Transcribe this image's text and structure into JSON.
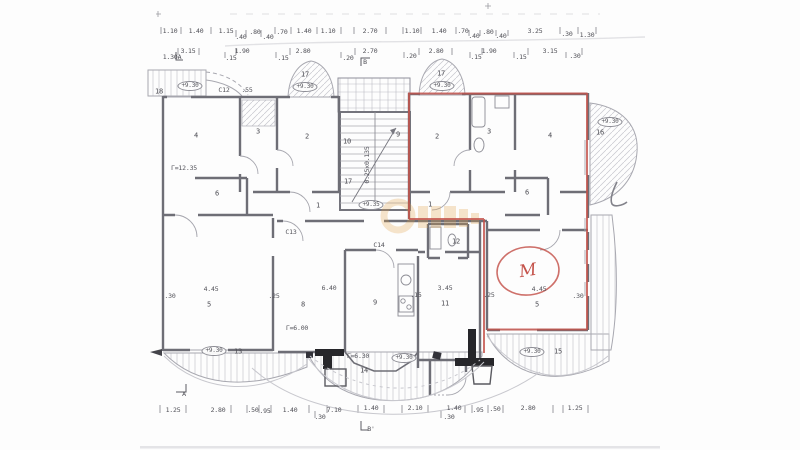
{
  "plan": {
    "red_marker_letter": "M",
    "red_color": "#c4524a",
    "watermark_color": "#e2a24b",
    "stair_note": "0.25x0.135"
  },
  "labels": {
    "dims_top_row1": [
      {
        "t": "1.10",
        "x": 170,
        "y": 31
      },
      {
        "t": "1.40",
        "x": 196,
        "y": 31
      },
      {
        "t": "1.15",
        "x": 226,
        "y": 31
      },
      {
        "t": ".40",
        "x": 241,
        "y": 37
      },
      {
        "t": ".80",
        "x": 255,
        "y": 32
      },
      {
        "t": ".40",
        "x": 268,
        "y": 37
      },
      {
        "t": ".70",
        "x": 282,
        "y": 32
      },
      {
        "t": "1.40",
        "x": 304,
        "y": 31
      },
      {
        "t": "1.10",
        "x": 328,
        "y": 31
      },
      {
        "t": "2.70",
        "x": 370,
        "y": 31
      },
      {
        "t": "1.10",
        "x": 412,
        "y": 31
      },
      {
        "t": "1.40",
        "x": 439,
        "y": 31
      },
      {
        "t": ".70",
        "x": 463,
        "y": 31
      },
      {
        "t": ".40",
        "x": 474,
        "y": 36
      },
      {
        "t": ".80",
        "x": 488,
        "y": 32
      },
      {
        "t": ".40",
        "x": 501,
        "y": 36
      },
      {
        "t": "3.25",
        "x": 535,
        "y": 31
      },
      {
        "t": ".30",
        "x": 567,
        "y": 34
      },
      {
        "t": "1.30",
        "x": 587,
        "y": 35
      }
    ],
    "dims_top_row2": [
      {
        "t": "1.30A",
        "x": 172,
        "y": 57
      },
      {
        "t": "3.15",
        "x": 188,
        "y": 51
      },
      {
        "t": ".15",
        "x": 231,
        "y": 58
      },
      {
        "t": "1.90",
        "x": 242,
        "y": 51
      },
      {
        "t": ".15",
        "x": 283,
        "y": 58
      },
      {
        "t": "2.80",
        "x": 303,
        "y": 51
      },
      {
        "t": ".20",
        "x": 348,
        "y": 58
      },
      {
        "t": "2.70",
        "x": 370,
        "y": 51
      },
      {
        "t": "B",
        "x": 365,
        "y": 62
      },
      {
        "t": ".20",
        "x": 411,
        "y": 56
      },
      {
        "t": "2.80",
        "x": 436,
        "y": 51
      },
      {
        "t": ".15",
        "x": 476,
        "y": 57
      },
      {
        "t": "1.90",
        "x": 489,
        "y": 51
      },
      {
        "t": ".15",
        "x": 521,
        "y": 57
      },
      {
        "t": "3.15",
        "x": 550,
        "y": 51
      },
      {
        "t": ".30",
        "x": 575,
        "y": 56
      }
    ],
    "dims_bottom": [
      {
        "t": "1.25",
        "x": 173,
        "y": 410
      },
      {
        "t": "2.80",
        "x": 218,
        "y": 410
      },
      {
        "t": ".50",
        "x": 253,
        "y": 410
      },
      {
        "t": ".95",
        "x": 265,
        "y": 411
      },
      {
        "t": "1.40",
        "x": 290,
        "y": 410
      },
      {
        "t": ".30",
        "x": 320,
        "y": 417
      },
      {
        "t": "7.10",
        "x": 334,
        "y": 410
      },
      {
        "t": "1.40",
        "x": 371,
        "y": 408
      },
      {
        "t": "2.10",
        "x": 415,
        "y": 408
      },
      {
        "t": "1.40",
        "x": 454,
        "y": 408
      },
      {
        "t": ".30",
        "x": 449,
        "y": 417
      },
      {
        "t": ".95",
        "x": 478,
        "y": 410
      },
      {
        "t": ".50",
        "x": 495,
        "y": 409
      },
      {
        "t": "2.80",
        "x": 528,
        "y": 408
      },
      {
        "t": "1.25",
        "x": 575,
        "y": 408
      },
      {
        "t": "A",
        "x": 184,
        "y": 394
      },
      {
        "t": "B'",
        "x": 371,
        "y": 429
      }
    ],
    "rooms": [
      {
        "t": "4",
        "x": 196,
        "y": 136
      },
      {
        "t": "3",
        "x": 258,
        "y": 132
      },
      {
        "t": "2",
        "x": 307,
        "y": 137
      },
      {
        "t": "2",
        "x": 437,
        "y": 137
      },
      {
        "t": "3",
        "x": 489,
        "y": 132
      },
      {
        "t": "4",
        "x": 550,
        "y": 136
      },
      {
        "t": "1",
        "x": 318,
        "y": 206
      },
      {
        "t": "1",
        "x": 430,
        "y": 205
      },
      {
        "t": "6",
        "x": 217,
        "y": 194
      },
      {
        "t": "6",
        "x": 527,
        "y": 193
      },
      {
        "t": "5",
        "x": 209,
        "y": 305
      },
      {
        "t": "8",
        "x": 303,
        "y": 305
      },
      {
        "t": "9",
        "x": 375,
        "y": 303
      },
      {
        "t": "11",
        "x": 445,
        "y": 304
      },
      {
        "t": "12",
        "x": 456,
        "y": 242
      },
      {
        "t": "5",
        "x": 537,
        "y": 305
      },
      {
        "t": "13",
        "x": 238,
        "y": 352
      },
      {
        "t": "14",
        "x": 364,
        "y": 371
      },
      {
        "t": "15",
        "x": 558,
        "y": 352
      },
      {
        "t": "16",
        "x": 600,
        "y": 133
      },
      {
        "t": "17",
        "x": 305,
        "y": 75
      },
      {
        "t": "17",
        "x": 441,
        "y": 74
      },
      {
        "t": "18",
        "x": 159,
        "y": 92
      },
      {
        "t": "10",
        "x": 347,
        "y": 142
      },
      {
        "t": "9",
        "x": 398,
        "y": 135
      },
      {
        "t": "17",
        "x": 348,
        "y": 182
      }
    ],
    "notes": [
      {
        "t": "Γ=12.35",
        "x": 184,
        "y": 168
      },
      {
        "t": "4.45",
        "x": 211,
        "y": 289
      },
      {
        "t": ".30",
        "x": 170,
        "y": 296
      },
      {
        "t": ".25",
        "x": 274,
        "y": 296
      },
      {
        "t": "6.40",
        "x": 329,
        "y": 288
      },
      {
        "t": "Γ=6.00",
        "x": 297,
        "y": 328
      },
      {
        "t": "3.45",
        "x": 445,
        "y": 288
      },
      {
        "t": ".15",
        "x": 416,
        "y": 295
      },
      {
        "t": ".25",
        "x": 489,
        "y": 295
      },
      {
        "t": "4.45",
        "x": 539,
        "y": 289
      },
      {
        "t": ".30",
        "x": 578,
        "y": 296
      },
      {
        "t": "Γ=6.30",
        "x": 358,
        "y": 356
      },
      {
        "t": "C12",
        "x": 224,
        "y": 90
      },
      {
        "t": ".55",
        "x": 247,
        "y": 90
      },
      {
        "t": "C13",
        "x": 291,
        "y": 232
      },
      {
        "t": "C14",
        "x": 379,
        "y": 245
      },
      {
        "t": "0.25x0.135",
        "x": 367,
        "y": 165,
        "v": 1
      }
    ],
    "levels": [
      {
        "t": "+9.30",
        "x": 190,
        "y": 86
      },
      {
        "t": "+9.30",
        "x": 305,
        "y": 87
      },
      {
        "t": "+9.30",
        "x": 442,
        "y": 86
      },
      {
        "t": "+9.30",
        "x": 610,
        "y": 122
      },
      {
        "t": "+9.35",
        "x": 371,
        "y": 205
      },
      {
        "t": "+9.30",
        "x": 214,
        "y": 351
      },
      {
        "t": "+9.30",
        "x": 404,
        "y": 358
      },
      {
        "t": "+9.30",
        "x": 532,
        "y": 352
      }
    ]
  }
}
